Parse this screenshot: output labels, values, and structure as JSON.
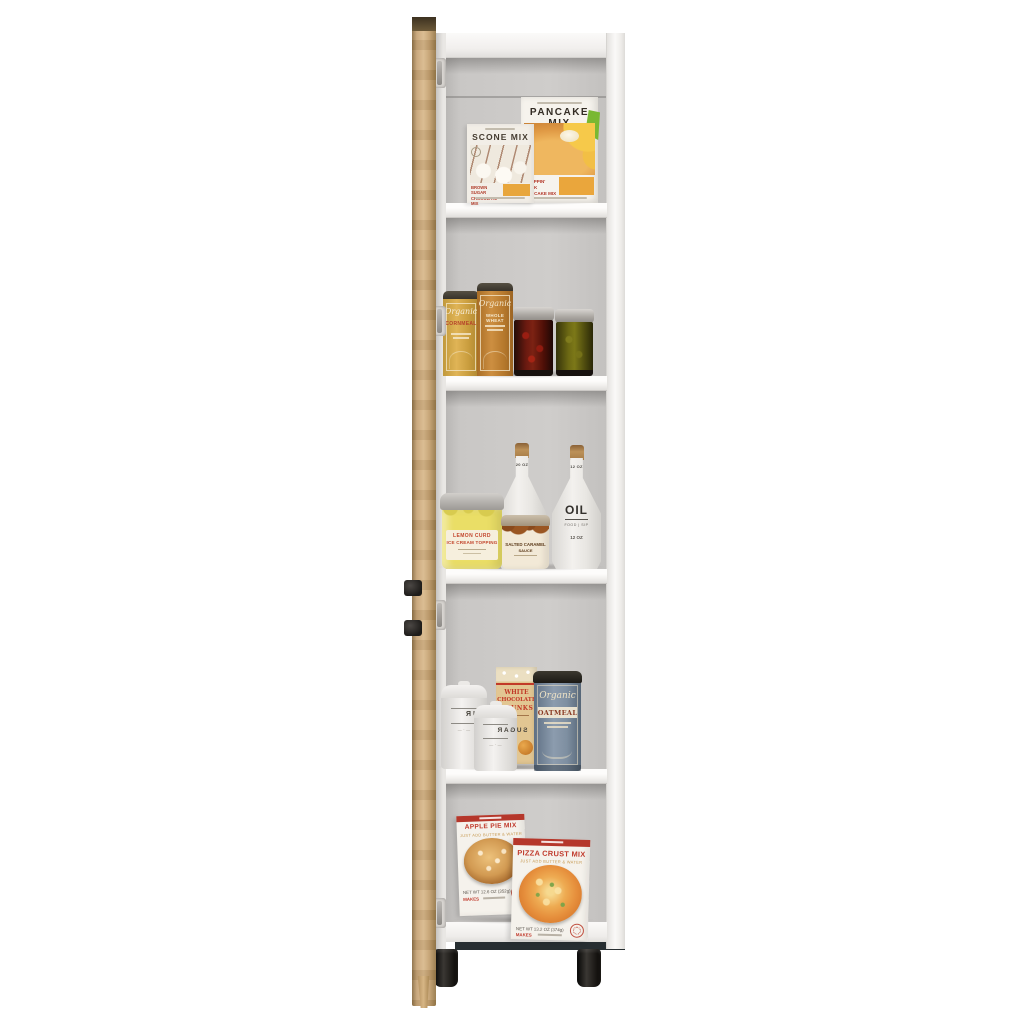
{
  "scene": {
    "subject": "Tall narrow white pantry cabinet with open light-oak door shown edge-on, five shelf sections stocked with pantry goods, two black cylindrical feet",
    "background": "#ffffff",
    "colors": {
      "door_wood": "#c7a477",
      "cabinet_white": "#f4f3f1",
      "interior_wall": "#c9c7c5",
      "feet_black": "#161412",
      "package_red": "#c0392b",
      "panel_orange": "#e8a63c"
    }
  },
  "shelves": {
    "top": {
      "scone_box": {
        "title": "SCONE MIX",
        "variant": "BROWN SUGAR CHOCOLATE MIX"
      },
      "pancake_box": {
        "title": "PANCAKE MIX",
        "variant": "FLAPPIN' JACK PANCAKE MIX"
      }
    },
    "second": {
      "cornmeal_canister": {
        "script": "Organic",
        "name": "CORNMEAL"
      },
      "wheat_canister": {
        "script": "Organic",
        "name": "WHOLE WHEAT"
      }
    },
    "middle": {
      "vinegar_bottle": {
        "name": "VINEGAR",
        "neck_size": "20 OZ"
      },
      "oil_bottle": {
        "name": "OIL",
        "tagline": "FOOD | SIP",
        "size": "12 OZ",
        "neck_size": "12 OZ"
      },
      "lemon_jar": {
        "line1": "LEMON CURD",
        "line2": "ICE CREAM TOPPING"
      },
      "caramel_jar": {
        "line1": "SALTED CARAMEL",
        "line2": "SAUCE"
      }
    },
    "fourth": {
      "flour_canister": {
        "name": "FLOUR"
      },
      "sugar_canister": {
        "name": "SUGAR"
      },
      "chocolate_box": {
        "line1": "WHITE",
        "line2": "CHOCOLATE",
        "line3": "CHUNKS"
      },
      "oatmeal_canister": {
        "script": "Organic",
        "name": "OATMEAL"
      }
    },
    "bottom": {
      "apple_pie_box": {
        "title": "APPLE PIE MIX",
        "subtitle": "JUST ADD BUTTER & WATER",
        "net_weight": "NET WT 12.6 OZ (352g)",
        "makes": "MAKES"
      },
      "pizza_box": {
        "title": "PIZZA CRUST MIX",
        "subtitle": "JUST ADD BUTTER & WATER",
        "net_weight": "NET WT 13.2 OZ (374g)",
        "makes": "MAKES"
      }
    }
  }
}
